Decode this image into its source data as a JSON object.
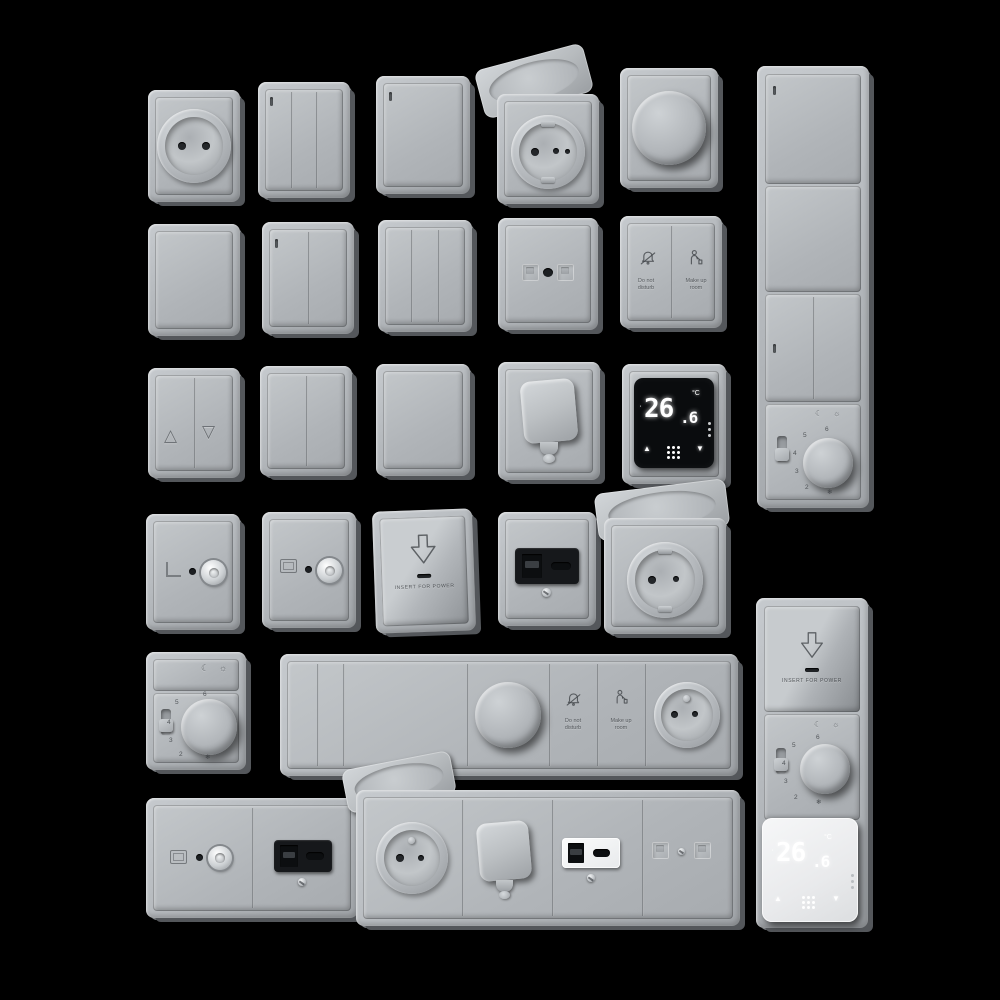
{
  "scene": {
    "background": "#000000",
    "plate_color": "#b4b8bc",
    "plate_edge_color": "#54575b",
    "black_module_color": "#0a0c0e",
    "white_module_color": "#f0f1f2",
    "description": "3D render catalog of gray wall switches, sockets and thermostats on black background"
  },
  "labels": {
    "dnd1": "Do not",
    "dnd2": "disturb",
    "mur1": "Make up",
    "mur2": "room",
    "insert": "INSERT FOR POWER"
  },
  "display": {
    "int": "26",
    "dec": ".6",
    "unit": "°C",
    "up": "▲",
    "down": "▼"
  },
  "dial": {
    "n2": "2",
    "n3": "3",
    "n4": "4",
    "n5": "5",
    "n6": "6",
    "freeze": "❄",
    "moon": "☾",
    "sun": "☼"
  },
  "shutter": {
    "up": "△",
    "down": "▽"
  },
  "modules": {
    "row1": [
      "french-socket",
      "3-gang-switch",
      "1-gang-switch",
      "covered-socket-open-lid",
      "rotary-dimmer",
      "vertical-4-unit-frame: switch, blank, 2-gang-switch, analog-thermostat"
    ],
    "row2": [
      "blank-plate",
      "2-gang-switch",
      "3-gang-switch",
      "data-socket-2-port",
      "hotel-service-switch: do-not-disturb / make-up-room"
    ],
    "row3": [
      "shutter-switch-up-down",
      "2-gang-switch",
      "1-gang-switch",
      "cable-outlet-spout",
      "digital-thermostat-black 26.6°C"
    ],
    "row4": [
      "tv-coax-socket",
      "tv-coax-socket",
      "key-card-holder INSERT FOR POWER",
      "usb-a-c-charger-black",
      "covered-schuko-socket-open-lid"
    ],
    "row5": [
      "analog-thermostat-dial-2-6",
      "horizontal-frame: 2 narrow switches, blank, dimmer, do-not-disturb, make-up-room, french-socket"
    ],
    "row6": [
      "double-frame: tv-coax-socket + usb-black",
      "horizontal-frame: covered-socket, cable-spout, usb-white, data-socket",
      "vertical-frame: key-card-holder, analog-thermostat, digital-thermostat-white 26.6°C"
    ]
  }
}
